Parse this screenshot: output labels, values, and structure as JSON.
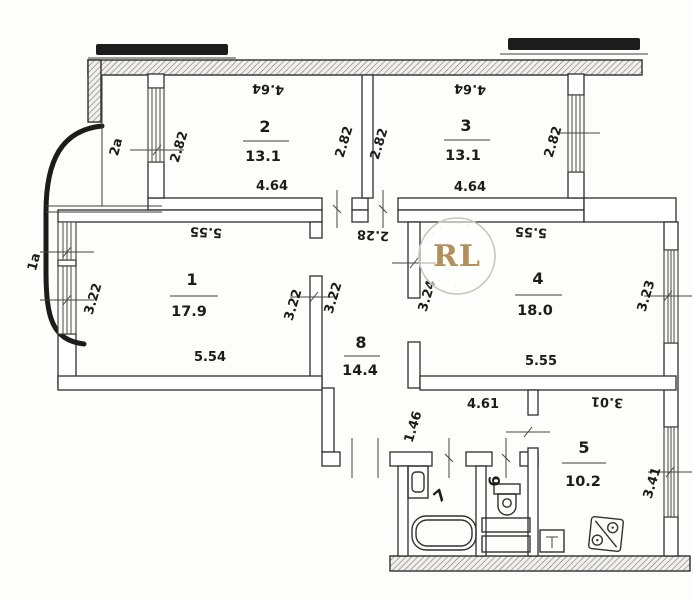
{
  "plan": {
    "watermark": {
      "initials": "RL",
      "accent_color": "#b2905a",
      "ring_top": "· · · · · ·",
      "ring_bottom": "· · · · ·"
    },
    "rooms": {
      "r1": {
        "number": "1",
        "area": "17.9"
      },
      "r2": {
        "number": "2",
        "area": "13.1"
      },
      "r3": {
        "number": "3",
        "area": "13.1"
      },
      "r4": {
        "number": "4",
        "area": "18.0"
      },
      "r5": {
        "number": "5",
        "area": "10.2"
      },
      "r6": {
        "number": "6"
      },
      "r7": {
        "number": "7"
      },
      "r8": {
        "number": "8",
        "area": "14.4"
      }
    },
    "balconies": {
      "b1": "1а",
      "b2": "2а"
    },
    "dims": {
      "r1": {
        "top": "5.55",
        "bottom": "5.54",
        "left": "3.22",
        "right": "3.22"
      },
      "r2": {
        "top": "4.64",
        "bottom": "4.64",
        "left": "2.82",
        "right": "2.82"
      },
      "r3": {
        "top": "4.64",
        "bottom": "4.64",
        "left": "2.82",
        "right": "2.82"
      },
      "r4": {
        "top": "5.55",
        "bottom": "5.55",
        "left": "3.24",
        "right": "3.23"
      },
      "r5": {
        "top": "3.01",
        "right": "3.41"
      },
      "r8": {
        "top": "2.28",
        "left": "3.22"
      },
      "hall": {
        "width": "4.61",
        "depth": "1.46"
      }
    }
  }
}
